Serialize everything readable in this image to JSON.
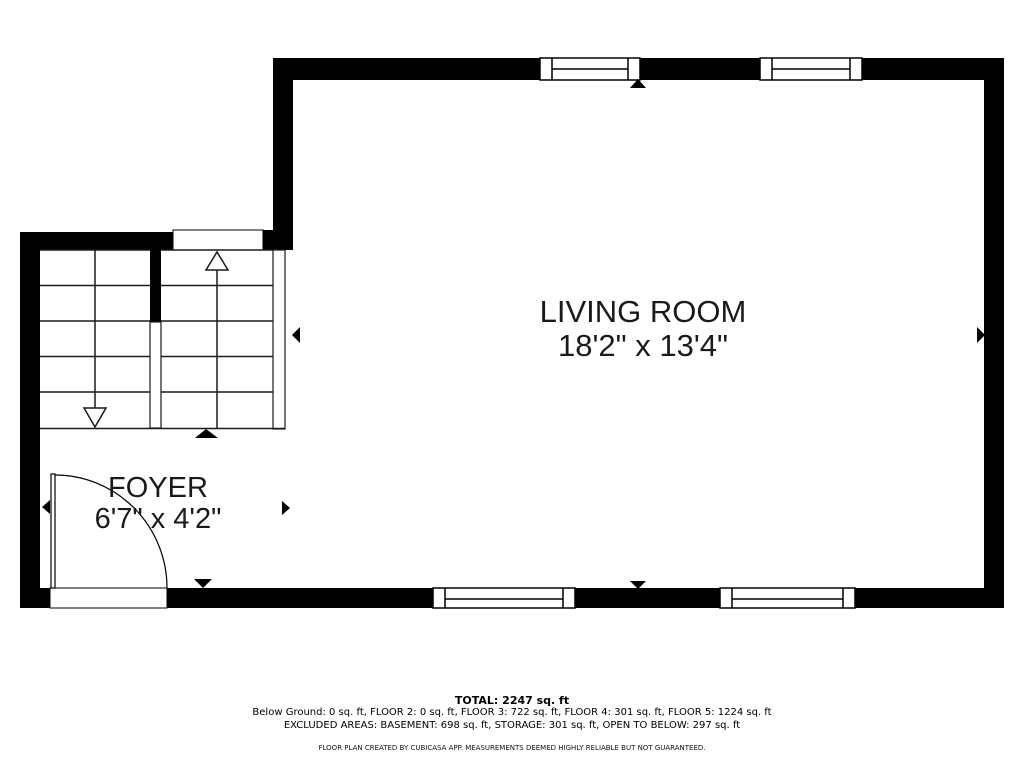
{
  "rooms": [
    {
      "name": "LIVING ROOM",
      "dims": "18'2\" x 13'4\""
    },
    {
      "name": "FOYER",
      "dims": "6'7\" x 4'2\""
    }
  ],
  "footer": {
    "total": "TOTAL: 2247 sq. ft",
    "floors": "Below Ground: 0 sq. ft, FLOOR 2: 0 sq. ft, FLOOR 3: 722 sq. ft, FLOOR 4: 301 sq. ft, FLOOR 5: 1224 sq. ft",
    "excluded": "EXCLUDED AREAS: BASEMENT: 698 sq. ft, STORAGE: 301 sq. ft, OPEN TO BELOW: 297 sq. ft",
    "disclaimer": "FLOOR PLAN CREATED BY CUBICASA APP. MEASUREMENTS DEEMED HIGHLY RELIABLE BUT NOT GUARANTEED."
  },
  "colors": {
    "wall": "#000000",
    "line": "#1a1a1a",
    "background": "#ffffff"
  }
}
